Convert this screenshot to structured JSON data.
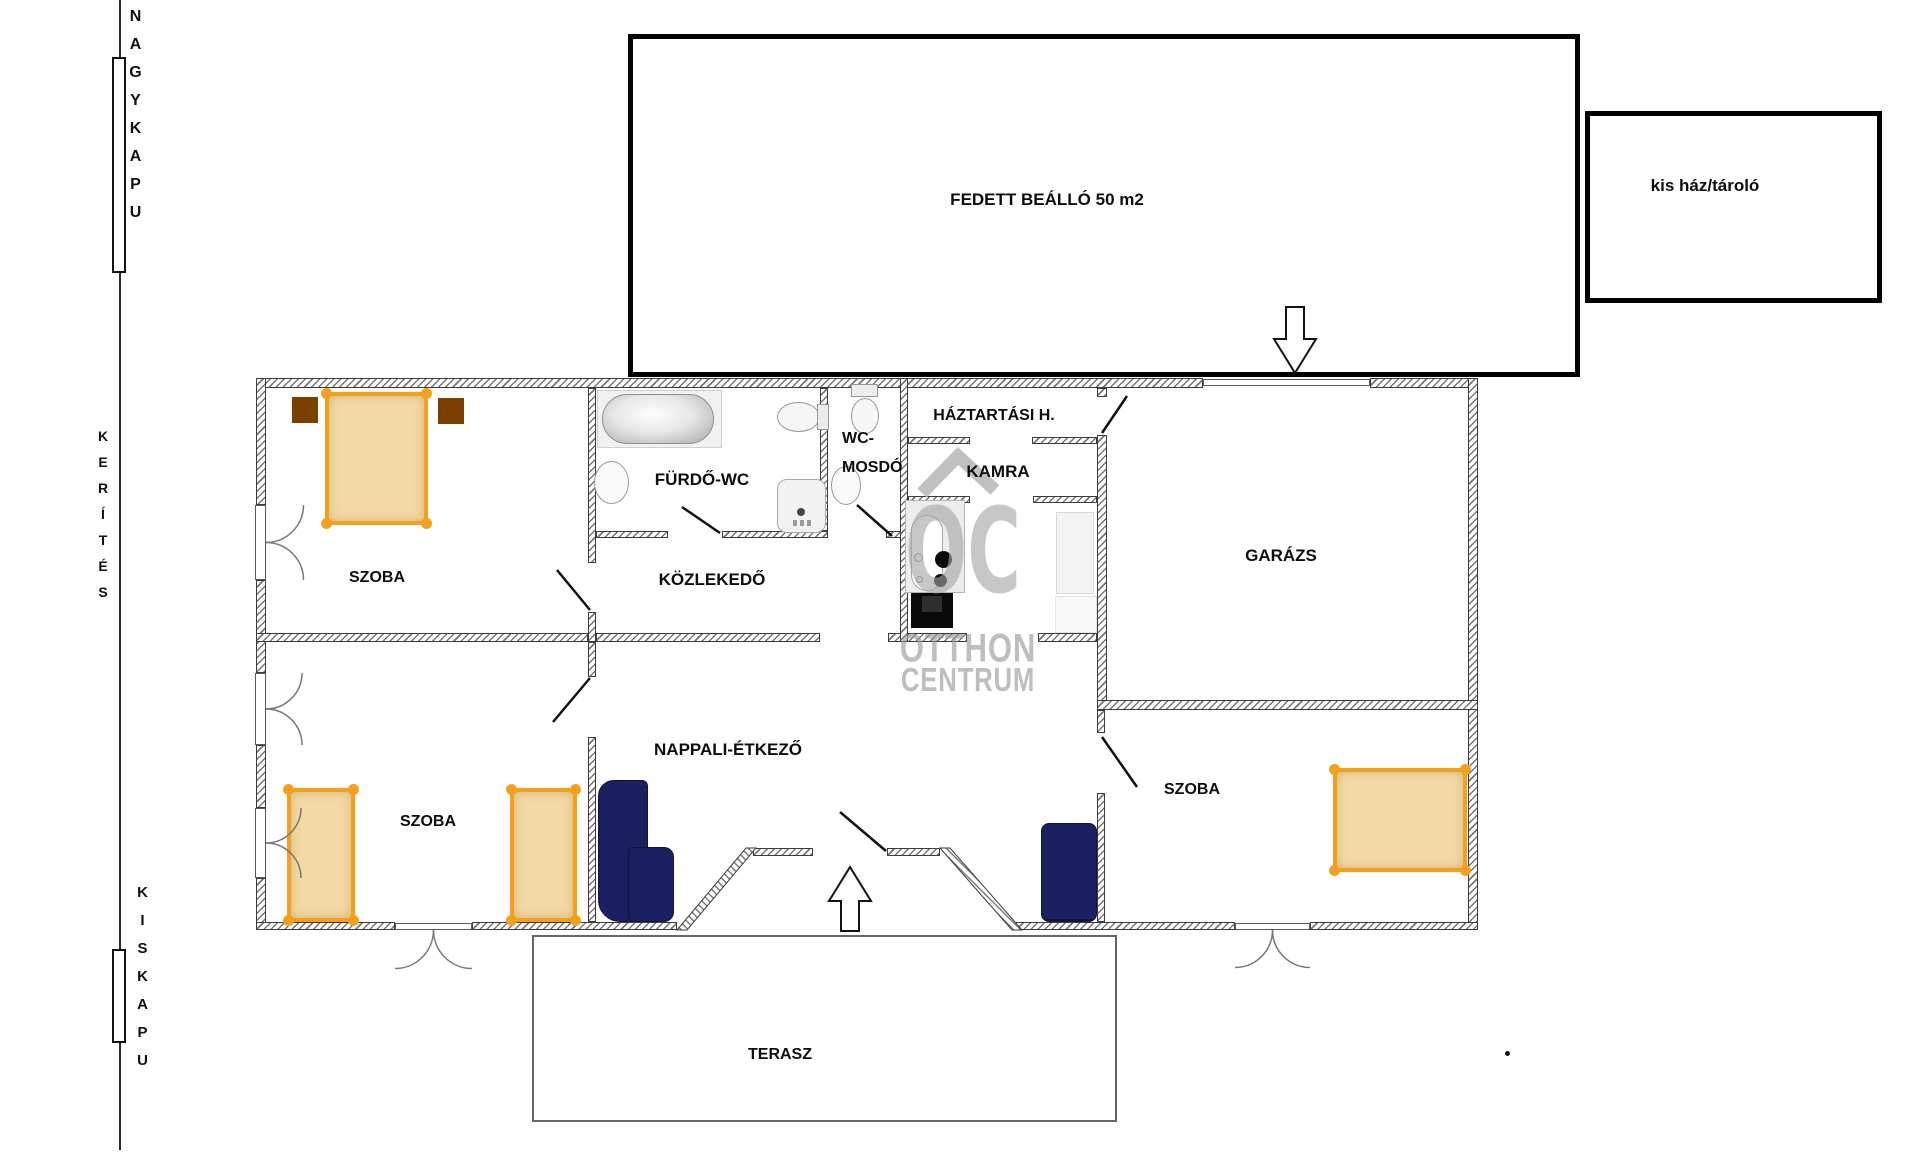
{
  "site": {
    "fence_top_gate_label": "NAGYKAPU",
    "fence_label": "KERÍTÉS",
    "fence_bottom_gate_label": "KISKAPU"
  },
  "outbuildings": {
    "carport_label": "FEDETT BEÁLLÓ  50 m2",
    "small_house_label": "kis ház/tároló"
  },
  "rooms": {
    "bedroom1": "SZOBA",
    "bedroom2": "SZOBA",
    "bedroom3": "SZOBA",
    "bathroom": "FÜRDŐ-WC",
    "wc_line1": "WC-",
    "wc_line2": "MOSDÓ",
    "hallway": "KÖZLEKEDŐ",
    "living_dining": "NAPPALI-ÉTKEZŐ",
    "utility": "HÁZTARTÁSI H.",
    "pantry": "KAMRA",
    "garage": "GARÁZS",
    "terrace": "TERASZ"
  },
  "watermark": {
    "logo": "OC",
    "line1": "OTTHON",
    "line2": "CENTRUM"
  },
  "colors": {
    "bed_frame": "#F5A01D",
    "bed_fill": "#F3D9A5",
    "nightstand": "#7B3F00",
    "sofa": "#1B2060",
    "watermark_gray": "#BDBDBD",
    "wall_line": "#3C3C3C",
    "outline_black": "#000000"
  }
}
